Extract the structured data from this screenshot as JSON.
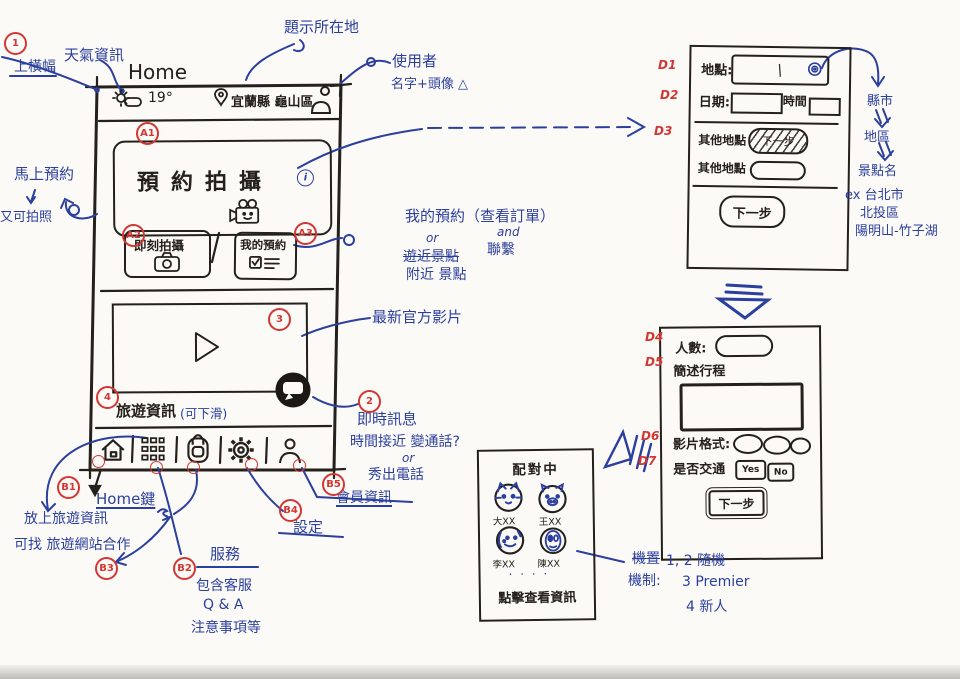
{
  "colors": {
    "ink_blue": "#2b3f9e",
    "ink_red": "#d23734",
    "ink_black": "#24201c",
    "paper": "#fbfaf6"
  },
  "markers": {
    "n1": "1",
    "n2": "2",
    "n3": "3",
    "n4": "4",
    "a1": "A1",
    "a2": "A2",
    "a3": "A3",
    "b1": "B1",
    "b2": "B2",
    "b3": "B3",
    "b4": "B4",
    "b5": "B5",
    "d1": "D1",
    "d2": "D2",
    "d3": "D3",
    "d4": "D4",
    "d5": "D5",
    "d6": "D6",
    "d7": "D7"
  },
  "phone": {
    "home_label": "Home",
    "status": {
      "temperature": "19°",
      "location": "宜蘭縣 龜山區"
    },
    "hero": {
      "title": "預約拍攝",
      "info": "i"
    },
    "quick_buttons": [
      {
        "label": "即刻拍攝"
      },
      {
        "label": "我的預約"
      }
    ],
    "travel": {
      "title": "旅遊資訊",
      "hint": "(可下滑)"
    }
  },
  "annotations": {
    "weather": "天氣資訊",
    "top_banner": "上橫幅",
    "show_location": "題示所在地",
    "user": "使用者",
    "user_detail": "名字+頭像 △",
    "book_now": "馬上預約",
    "also_shoot": "又可拍照",
    "my_booking": "我的預約（查看訂單）",
    "or1": "or",
    "and1": "and",
    "contact": "聯繫",
    "near_spots_strike": "遊近景點",
    "nearby_spots": "附近 景點",
    "latest_video": "最新官方影片",
    "instant_message": "即時訊息",
    "time_near": "時間接近 變通話?",
    "or2": "or",
    "show_phone": "秀出電話",
    "home_key": "Home鍵",
    "put_travel_info": "放上旅遊資訊",
    "find_partner": "可找 旅遊網站合作",
    "service": "服務",
    "service_line1": "包含客服",
    "service_line2": "Q & A",
    "service_line3": "注意事項等",
    "settings": "設定",
    "member_info": "會員資訊",
    "scribble": "曾"
  },
  "flow_notes": {
    "county": "縣市",
    "district": "地區",
    "spot_name": "景點名",
    "example1": "ex 台北市",
    "example2": "北投區",
    "example3": "陽明山-竹子湖"
  },
  "panel1": {
    "location_label": "地點:",
    "location_value": "/",
    "date_label": "日期:",
    "time_label": "時間",
    "other_label1": "其他地點",
    "crossed_button": "下一步",
    "other_label2": "其他地點",
    "next_button": "下一步"
  },
  "panel2": {
    "people_label": "人數:",
    "itinerary_label": "簡述行程",
    "format_label": "影片格式:",
    "transport_label": "是否交通",
    "yes": "Yes",
    "no": "No",
    "next_button": "下一步"
  },
  "match_card": {
    "title": "配對中",
    "members": [
      {
        "name": "大XX"
      },
      {
        "name": "王XX"
      },
      {
        "name": "李XX"
      },
      {
        "name": "陳XX"
      }
    ],
    "ellipsis": "· · · ·",
    "footer": "點擊查看資訊"
  },
  "mechanism": {
    "crossed": "機置",
    "label": "機制:",
    "rule1": "1, 2 隨機",
    "rule2": "3 Premier",
    "rule3": "4 新人"
  }
}
